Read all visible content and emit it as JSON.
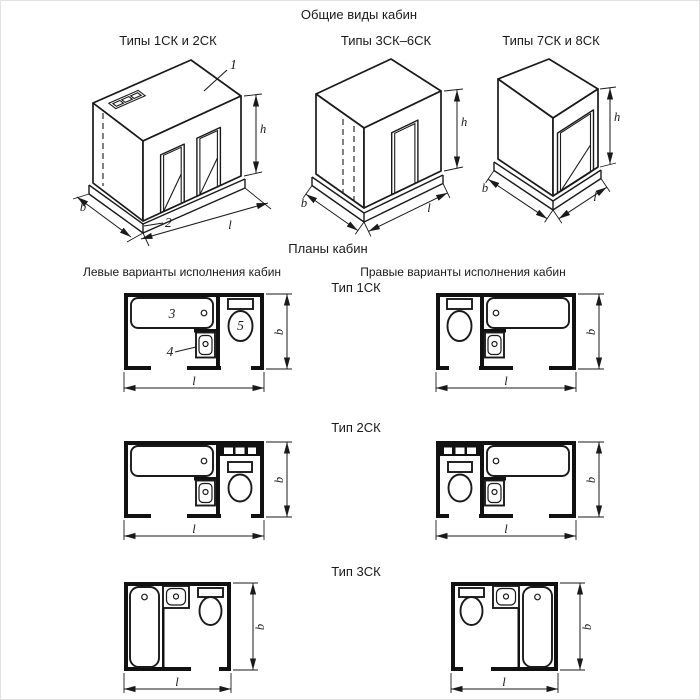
{
  "headers": {
    "title": "Общие виды кабин",
    "iso1_label": "Типы 1СК и 2СК",
    "iso2_label": "Типы 3СК–6СК",
    "iso3_label": "Типы 7СК и 8СК",
    "plans_title": "Планы кабин",
    "left_variants": "Левые варианты исполнения кабин",
    "right_variants": "Правые варианты исполнения кабин",
    "type1_label": "Тип 1СК",
    "type2_label": "Тип 2СК",
    "type3_label": "Тип 3СК"
  },
  "dim_labels": {
    "width": "b",
    "length": "l",
    "height": "h"
  },
  "callouts": {
    "cabin": "1",
    "base": "2",
    "bath": "3",
    "washbasin": "4",
    "toilet": "5"
  },
  "colors": {
    "line": "#1a1a1a",
    "wall_fill": "#111111",
    "background": "#ffffff"
  }
}
